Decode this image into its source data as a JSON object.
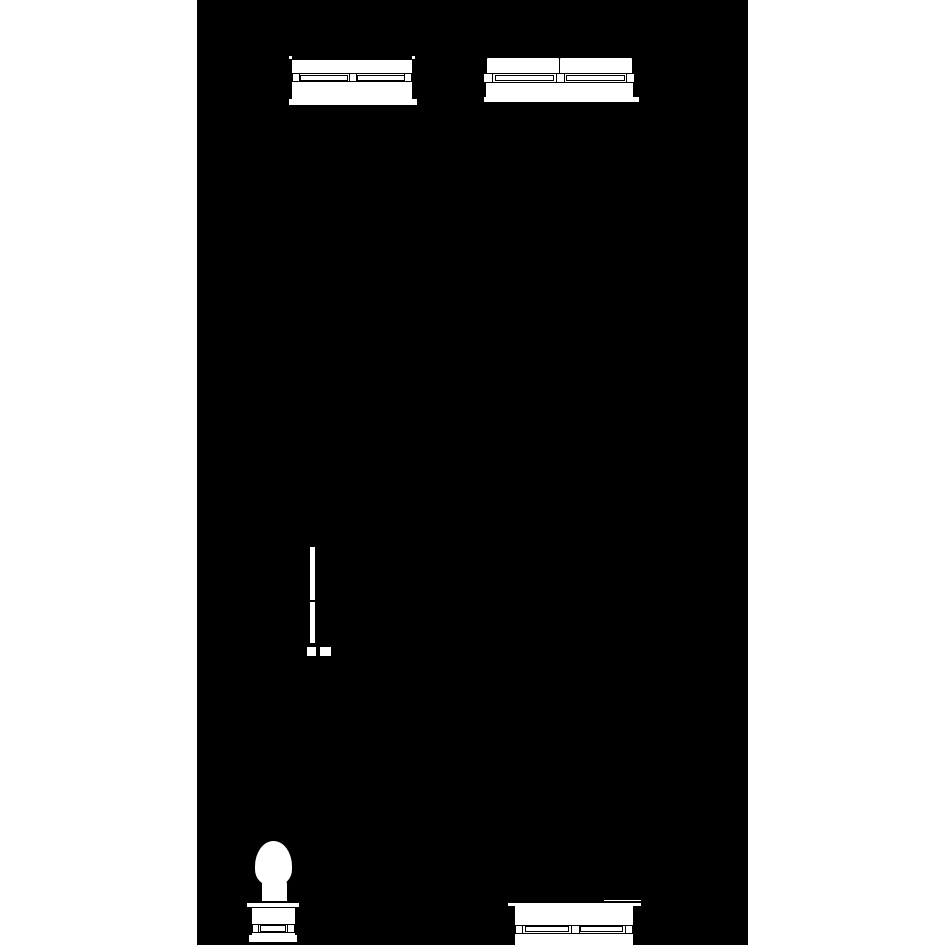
{
  "scene": {
    "page_background": "#ffffff",
    "ink": "#000000",
    "paper": "#ffffff",
    "canvas": {
      "x": 197,
      "y": 0,
      "width": 551,
      "height": 945,
      "background": "#000000"
    },
    "objects": [
      {
        "name": "sofa-elevation-top-left",
        "parts": [
          {
            "name": "corner-tick-left",
            "x": 288.5,
            "y": 55.5,
            "w": 3,
            "h": 3,
            "fill": "#ffffff"
          },
          {
            "name": "corner-tick-right",
            "x": 411.5,
            "y": 55.5,
            "w": 3,
            "h": 3,
            "fill": "#ffffff"
          },
          {
            "name": "base-bar",
            "x": 289,
            "y": 98.5,
            "w": 128,
            "h": 8,
            "fill": "#ffffff",
            "bw": "0 0 2px 0"
          },
          {
            "name": "body-panel",
            "x": 292,
            "y": 60,
            "w": 120,
            "h": 39,
            "fill": "#ffffff"
          },
          {
            "name": "rail-band",
            "x": 292,
            "y": 73,
            "w": 120,
            "h": 9,
            "fill": "#ffffff",
            "bw": "1px 0"
          },
          {
            "name": "rail-panel-left",
            "x": 300,
            "y": 74.5,
            "w": 48,
            "h": 6,
            "fill": "#ffffff",
            "bw": "1px"
          },
          {
            "name": "rail-panel-right",
            "x": 357,
            "y": 74.5,
            "w": 48,
            "h": 6,
            "fill": "#ffffff",
            "bw": "1px"
          },
          {
            "name": "rail-block-left",
            "x": 292,
            "y": 73,
            "w": 8,
            "h": 9,
            "fill": "#ffffff",
            "bw": "1px"
          },
          {
            "name": "rail-block-center",
            "x": 348.5,
            "y": 73,
            "w": 8,
            "h": 9,
            "fill": "#ffffff",
            "bw": "1px"
          },
          {
            "name": "rail-block-right",
            "x": 404,
            "y": 73,
            "w": 8,
            "h": 9,
            "fill": "#ffffff",
            "bw": "1px"
          }
        ]
      },
      {
        "name": "sofa-elevation-top-right",
        "parts": [
          {
            "name": "base-bar",
            "x": 484,
            "y": 96.5,
            "w": 155,
            "h": 7,
            "fill": "#ffffff",
            "bw": "0 0 2px 0"
          },
          {
            "name": "body-panel",
            "x": 486,
            "y": 81,
            "w": 147,
            "h": 16,
            "fill": "#ffffff"
          },
          {
            "name": "seat-cushion-left",
            "x": 486,
            "y": 57,
            "w": 74,
            "h": 16.5,
            "fill": "#ffffff",
            "bw": "1px",
            "rad": "2px 2px 0 0"
          },
          {
            "name": "seat-cushion-right",
            "x": 559,
            "y": 57,
            "w": 74,
            "h": 16.5,
            "fill": "#ffffff",
            "bw": "1px",
            "rad": "2px 2px 0 0"
          },
          {
            "name": "rail-band",
            "x": 483,
            "y": 73,
            "w": 151,
            "h": 9.5,
            "fill": "#ffffff",
            "bw": "1px 0"
          },
          {
            "name": "rail-panel-left",
            "x": 495,
            "y": 74.5,
            "w": 59,
            "h": 6.5,
            "fill": "#ffffff",
            "bw": "1px"
          },
          {
            "name": "rail-panel-right",
            "x": 566,
            "y": 74.5,
            "w": 59,
            "h": 6.5,
            "fill": "#ffffff",
            "bw": "1px"
          },
          {
            "name": "rail-block-left",
            "x": 483,
            "y": 72.5,
            "w": 10,
            "h": 10.5,
            "fill": "#ffffff",
            "bw": "1px"
          },
          {
            "name": "rail-block-center",
            "x": 555.5,
            "y": 72.5,
            "w": 9,
            "h": 10.5,
            "fill": "#ffffff",
            "bw": "1px"
          },
          {
            "name": "rail-block-right",
            "x": 625.5,
            "y": 72.5,
            "w": 9,
            "h": 10.5,
            "fill": "#ffffff",
            "bw": "1px"
          }
        ]
      },
      {
        "name": "side-profile-panel",
        "parts": [
          {
            "name": "panel-strip",
            "x": 309.5,
            "y": 547,
            "w": 5.5,
            "h": 96,
            "fill": "#ffffff"
          },
          {
            "name": "strip-joint",
            "x": 309,
            "y": 600,
            "w": 6.5,
            "h": 2,
            "fill": "#000000"
          },
          {
            "name": "foot-left",
            "x": 306,
            "y": 646,
            "w": 10.5,
            "h": 11,
            "fill": "#ffffff",
            "bw": "1px"
          },
          {
            "name": "foot-right",
            "x": 319,
            "y": 646,
            "w": 13,
            "h": 11,
            "fill": "#ffffff",
            "bw": "1px"
          }
        ]
      },
      {
        "name": "pedestal-chair-elevation",
        "parts": [
          {
            "name": "backrest-oval",
            "x": 255,
            "y": 841,
            "w": 37,
            "h": 44,
            "fill": "#ffffff",
            "rad": "19px 19px 14px 14px / 26px 26px 16px 16px"
          },
          {
            "name": "seat-neck",
            "x": 262,
            "y": 879,
            "w": 25,
            "h": 24,
            "fill": "#ffffff",
            "rad": "5px 5px 0 0"
          },
          {
            "name": "collar-bar",
            "x": 245.5,
            "y": 901,
            "w": 54,
            "h": 6.5,
            "fill": "#ffffff",
            "bw": "2px 1px 1px 1px"
          },
          {
            "name": "pedestal-body",
            "x": 252,
            "y": 907.5,
            "w": 43,
            "h": 30,
            "fill": "#ffffff"
          },
          {
            "name": "band",
            "x": 252,
            "y": 923.5,
            "w": 43,
            "h": 9.5,
            "fill": "#ffffff",
            "bw": "1px 0"
          },
          {
            "name": "band-panel",
            "x": 259.5,
            "y": 925,
            "w": 26,
            "h": 6.5,
            "fill": "#ffffff",
            "bw": "1px"
          },
          {
            "name": "band-block-left",
            "x": 252,
            "y": 923.5,
            "w": 6.5,
            "h": 9.5,
            "fill": "#ffffff",
            "bw": "1px"
          },
          {
            "name": "band-block-right",
            "x": 286.5,
            "y": 923.5,
            "w": 8.5,
            "h": 9.5,
            "fill": "#ffffff",
            "bw": "1px"
          },
          {
            "name": "plinth",
            "x": 248.5,
            "y": 935,
            "w": 48,
            "h": 9,
            "fill": "#ffffff",
            "bw": "0 0 2px 0"
          }
        ]
      },
      {
        "name": "sofa-elevation-bottom",
        "parts": [
          {
            "name": "cap-step",
            "x": 604,
            "y": 898,
            "w": 37,
            "h": 4,
            "fill": "#ffffff",
            "bw": "2px 0 0 0"
          },
          {
            "name": "cap-bar",
            "x": 508,
            "y": 900.5,
            "w": 133,
            "h": 5,
            "fill": "#ffffff",
            "bw": "2px 0 0 0"
          },
          {
            "name": "body-panel",
            "x": 515,
            "y": 905,
            "w": 118,
            "h": 20,
            "fill": "#ffffff"
          },
          {
            "name": "rail-band",
            "x": 515,
            "y": 924.5,
            "w": 118,
            "h": 9,
            "fill": "#ffffff",
            "bw": "1px 0"
          },
          {
            "name": "rail-panel-left",
            "x": 525,
            "y": 926,
            "w": 44,
            "h": 6,
            "fill": "#ffffff",
            "bw": "1px"
          },
          {
            "name": "rail-panel-right",
            "x": 580,
            "y": 926,
            "w": 43,
            "h": 6,
            "fill": "#ffffff",
            "bw": "1px"
          },
          {
            "name": "rail-block-left",
            "x": 515,
            "y": 924.5,
            "w": 8,
            "h": 9,
            "fill": "#ffffff",
            "bw": "1px"
          },
          {
            "name": "rail-block-center",
            "x": 570.5,
            "y": 924.5,
            "w": 9,
            "h": 9,
            "fill": "#ffffff",
            "bw": "1px"
          },
          {
            "name": "rail-block-right",
            "x": 625,
            "y": 924.5,
            "w": 8,
            "h": 9,
            "fill": "#ffffff",
            "bw": "1px"
          },
          {
            "name": "skirt-panel",
            "x": 515,
            "y": 933.5,
            "w": 118,
            "h": 11.5,
            "fill": "#ffffff"
          }
        ]
      }
    ]
  }
}
